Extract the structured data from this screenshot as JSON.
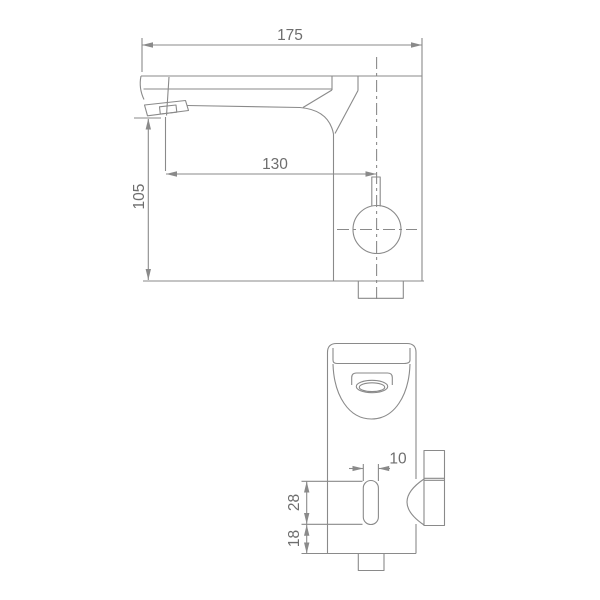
{
  "drawing": {
    "kind": "technical-dimension-drawing",
    "dims": {
      "d175": "175",
      "d130": "130",
      "d105": "105",
      "d10": "10",
      "d28": "28",
      "d18": "18"
    },
    "colors": {
      "line": "#8a8a8a",
      "text": "#6e6e6e",
      "background": "#ffffff"
    }
  }
}
